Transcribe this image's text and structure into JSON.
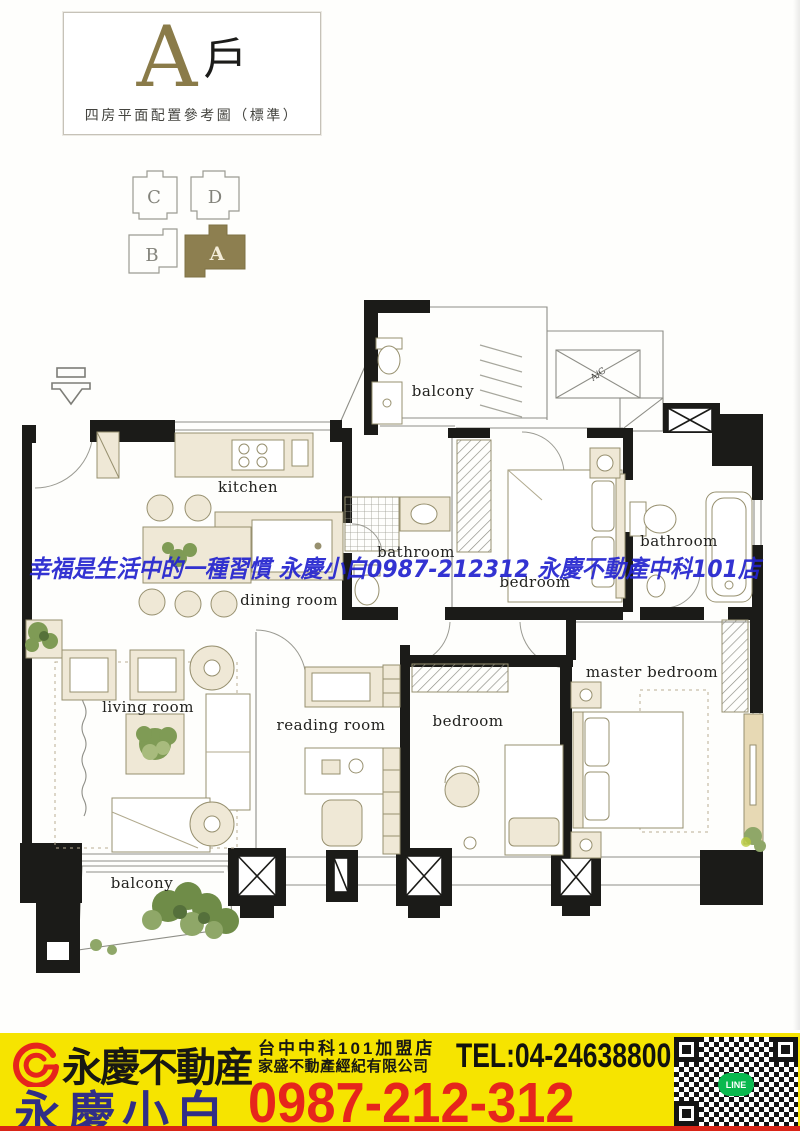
{
  "title_block": {
    "unit_letter": "A",
    "unit_suffix": "戶",
    "subtitle": "四房平面配置參考圖（標準）"
  },
  "key_plan": {
    "units": [
      {
        "label": "C",
        "highlighted": false
      },
      {
        "label": "D",
        "highlighted": false
      },
      {
        "label": "B",
        "highlighted": false
      },
      {
        "label": "A",
        "highlighted": true
      }
    ],
    "highlight_color": "#8d7f50"
  },
  "plan": {
    "labels": {
      "balcony_top": "balcony",
      "kitchen": "kitchen",
      "dining": "dining room",
      "bathroom_1": "bathroom",
      "bedroom_2": "bedroom",
      "bathroom_2": "bathroom",
      "living": "living room",
      "reading": "reading room",
      "bedroom_3": "bedroom",
      "master": "master bedroom",
      "balcony_bottom": "balcony",
      "ac": "A/C"
    }
  },
  "watermark": {
    "text": "幸福是生活中的一種習慣 永慶小白0987-212312 永慶不動產中科101店",
    "color": "#2424cf"
  },
  "banner": {
    "bg": "#f6e400",
    "brand": "永慶不動産",
    "store_line1": "台中中科101加盟店",
    "store_line2": "家盛不動產經紀有限公司",
    "tel": "TEL:04-24638800",
    "agent": "永慶小白",
    "phone": "0987-212-312",
    "qr_label": "LINE",
    "brand_color": "#181813",
    "agent_color": "#312e86",
    "phone_color": "#e6251c"
  }
}
